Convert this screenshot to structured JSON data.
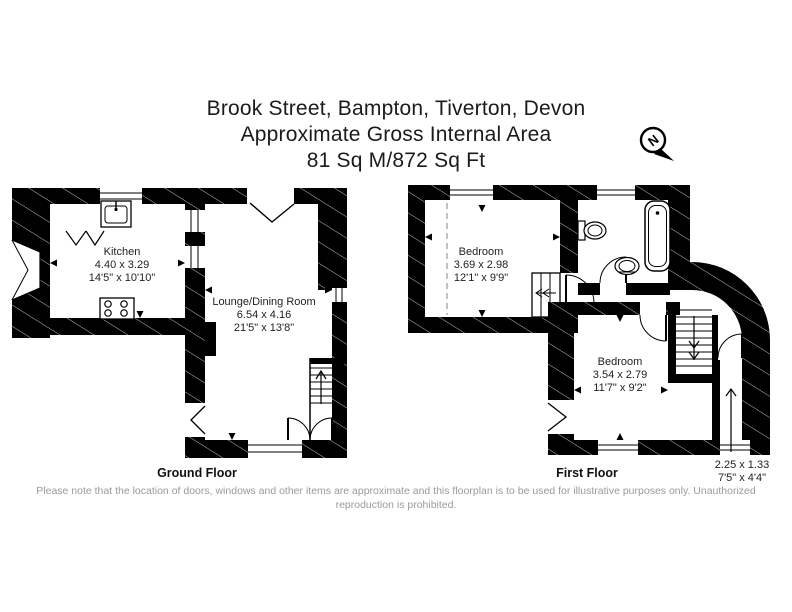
{
  "title": {
    "address": "Brook Street, Bampton, Tiverton, Devon",
    "area_line": "Approximate Gross Internal Area",
    "area_value": "81 Sq M/872 Sq Ft"
  },
  "compass": {
    "label": "N"
  },
  "ground_floor": {
    "label": "Ground Floor",
    "rooms": [
      {
        "name": "Kitchen",
        "metric": "4.40 x 3.29",
        "imperial": "14'5\" x 10'10\""
      },
      {
        "name": "Lounge/Dining Room",
        "metric": "6.54 x 4.16",
        "imperial": "21'5\" x 13'8\""
      }
    ]
  },
  "first_floor": {
    "label": "First Floor",
    "rooms": [
      {
        "name": "Bedroom",
        "metric": "3.69 x 2.98",
        "imperial": "12'1\" x 9'9\""
      },
      {
        "name": "Bedroom",
        "metric": "3.54 x 2.79",
        "imperial": "11'7\" x 9'2\""
      },
      {
        "metric": "2.25 x 1.33",
        "imperial": "7'5\" x 4'4\""
      }
    ]
  },
  "disclaimer": "Please note that the location of doors, windows and other items are approximate and this floorplan is to be used for illustrative purposes only. Unauthorized reproduction is prohibited.",
  "colors": {
    "wall": "#000000",
    "text": "#1b1b1b",
    "muted": "#9a9a9a",
    "background": "#ffffff"
  }
}
